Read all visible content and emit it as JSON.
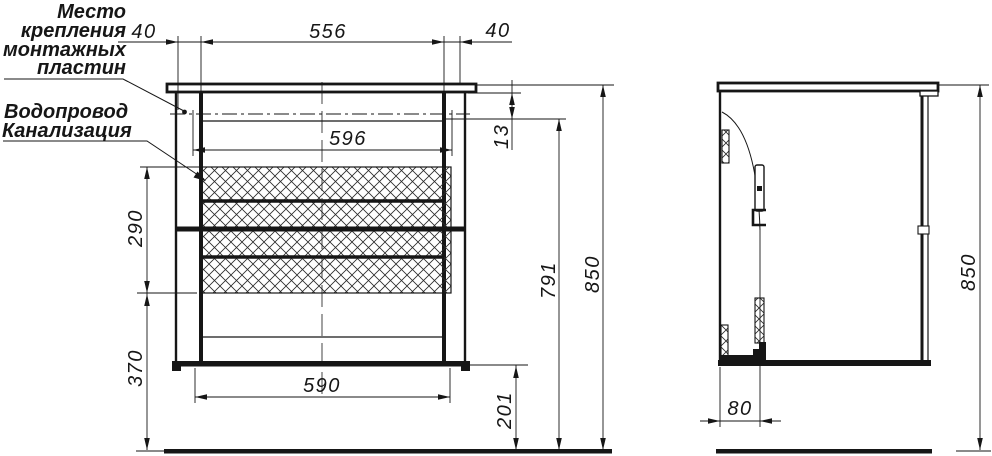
{
  "drawing": {
    "type": "technical-drawing",
    "views": [
      "front-view",
      "side-view"
    ],
    "units": "mm"
  },
  "labels": {
    "mounting_plates": [
      "Место",
      "крепления",
      "монтажных",
      "пластин"
    ],
    "plumbing": [
      "Водопровод",
      "Канализация"
    ]
  },
  "dimensions": {
    "plate_offset_left": "40",
    "plate_spacing": "556",
    "plate_offset_right": "40",
    "carcass_width": "596",
    "plate_drop": "13",
    "plumbing_zone_height": "290",
    "lower_zone_height": "370",
    "bottom_width": "590",
    "floor_clearance": "201",
    "plate_height_from_floor": "791",
    "total_height": "850",
    "side_total_height": "850",
    "side_plate_depth": "80"
  },
  "colors": {
    "ink": "#161616",
    "background": "#ffffff"
  }
}
